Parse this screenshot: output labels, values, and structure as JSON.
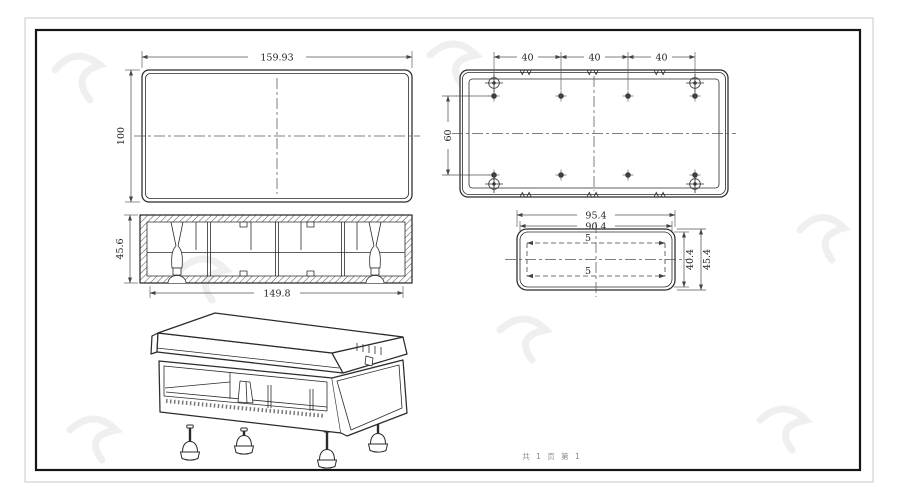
{
  "page": {
    "footer_text": "共 1 页  第 1"
  },
  "views": {
    "front_view": {
      "dims": {
        "width": "159.93",
        "height": "100"
      }
    },
    "bottom_view": {
      "dims": {
        "spacing": [
          "40",
          "40",
          "40"
        ],
        "row_gap": "60"
      }
    },
    "section_view": {
      "dims": {
        "height": "45.6",
        "width": "149.8"
      }
    },
    "end_view": {
      "dims": {
        "outer_width": "95.4",
        "inner_width": "90.4",
        "top_wall": "5",
        "bottom_wall": "5",
        "inner_height": "40.4",
        "outer_height": "45.4"
      }
    }
  },
  "colors": {
    "drawing_line": "#2b2b2b",
    "dimension_line": "#555555",
    "frame_inner": "#151515",
    "frame_outer": "#c8c8c8",
    "watermark": "#ededed",
    "background": "#ffffff"
  }
}
